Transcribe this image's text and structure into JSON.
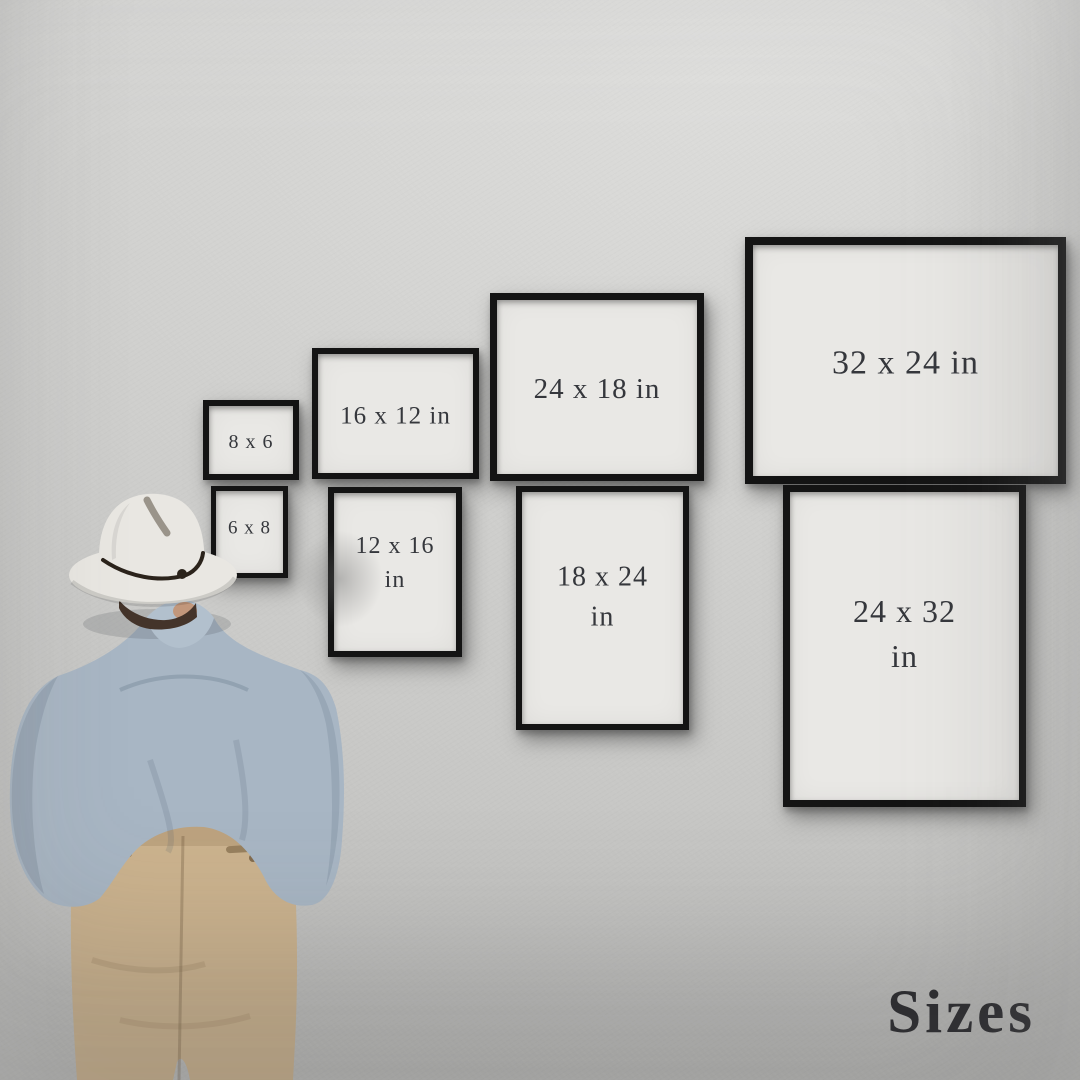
{
  "scene": {
    "corner_label": "Sizes",
    "wall_color_top": "#dddddb",
    "wall_color_bottom": "#bdbdbb",
    "frame_border_color": "#141414",
    "paper_color": "#e9e8e5",
    "label_text_color": "#35373c",
    "corner_label_color": "#26262a"
  },
  "frames": [
    {
      "name": "frame-8x6",
      "label": "8 x 6",
      "label2": "",
      "x": 203,
      "y": 400,
      "w": 84,
      "h": 68,
      "border": 6,
      "font": 20,
      "orientation": "landscape"
    },
    {
      "name": "frame-16x12",
      "label": "16 x 12 in",
      "label2": "",
      "x": 312,
      "y": 348,
      "w": 155,
      "h": 119,
      "border": 6,
      "font": 25,
      "orientation": "landscape"
    },
    {
      "name": "frame-24x18",
      "label": "24 x 18 in",
      "label2": "",
      "x": 490,
      "y": 293,
      "w": 200,
      "h": 174,
      "border": 7,
      "font": 29,
      "orientation": "landscape"
    },
    {
      "name": "frame-32x24",
      "label": "32 x 24 in",
      "label2": "",
      "x": 745,
      "y": 237,
      "w": 305,
      "h": 231,
      "border": 8,
      "font": 34,
      "orientation": "landscape"
    },
    {
      "name": "frame-6x8",
      "label": "6 x 8",
      "label2": "",
      "x": 211,
      "y": 486,
      "w": 67,
      "h": 82,
      "border": 5,
      "font": 19,
      "orientation": "portrait"
    },
    {
      "name": "frame-12x16",
      "label": "12 x 16",
      "label2": "in",
      "x": 328,
      "y": 487,
      "w": 122,
      "h": 158,
      "border": 6,
      "font": 24,
      "orientation": "portrait"
    },
    {
      "name": "frame-18x24",
      "label": "18 x 24",
      "label2": "in",
      "x": 516,
      "y": 486,
      "w": 161,
      "h": 232,
      "border": 6,
      "font": 28,
      "orientation": "portrait"
    },
    {
      "name": "frame-24x32",
      "label": "24 x 32",
      "label2": "in",
      "x": 783,
      "y": 485,
      "w": 229,
      "h": 308,
      "border": 7,
      "font": 32,
      "orientation": "portrait"
    }
  ],
  "person": {
    "hat_color": "#e9e7e2",
    "hat_band_color": "#2b231b",
    "hair_color": "#44342a",
    "skin_color": "#c2977b",
    "shirt_color": "#a8b6c4",
    "collar_color": "#b2c0cd",
    "pants_color": "#ccb38e"
  }
}
